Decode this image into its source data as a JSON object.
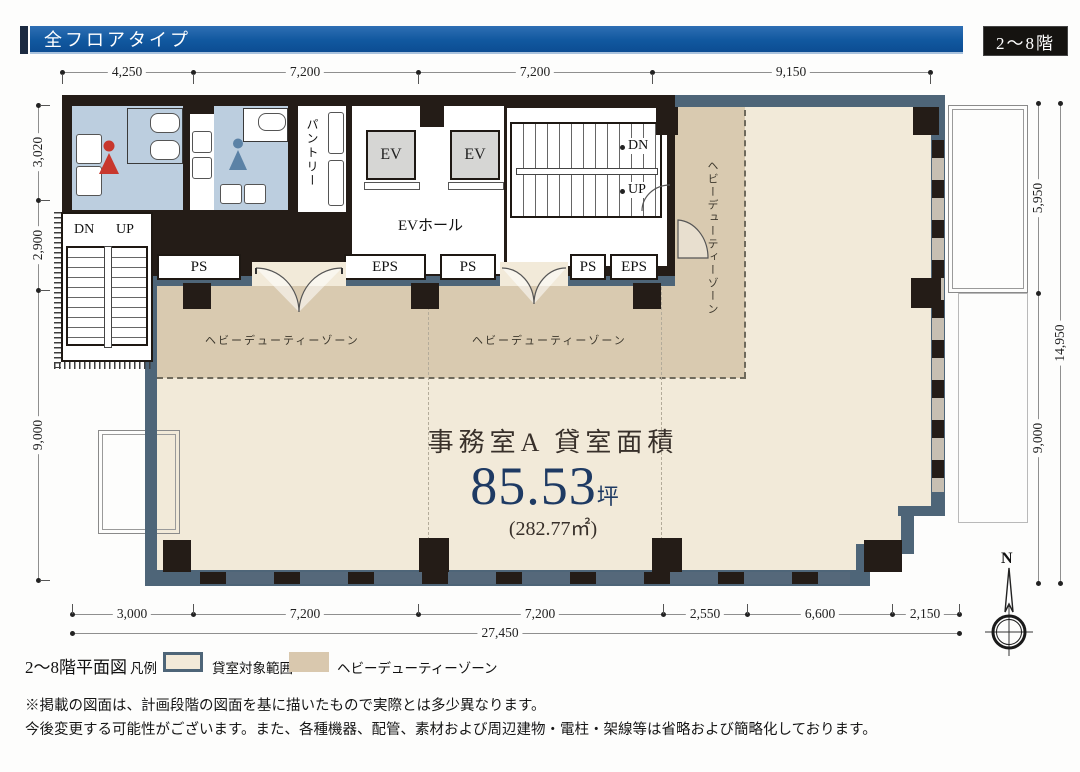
{
  "header": {
    "title": "全フロアタイプ",
    "floor_badge": "2〜8階"
  },
  "plan": {
    "core": {
      "pantry_label": "パントリー",
      "ev_labels": [
        "EV",
        "EV"
      ],
      "ev_hall_label": "EVホール",
      "main_stair": {
        "dn": "DN",
        "up": "UP"
      },
      "left_stair": {
        "dn": "DN",
        "up": "UP"
      }
    },
    "shaft_labels": [
      "PS",
      "EPS",
      "PS",
      "PS",
      "EPS"
    ],
    "zones": {
      "heavy_duty_horizontal": [
        "ヘビーデューティーゾーン",
        "ヘビーデューティーゾーン"
      ],
      "heavy_duty_vertical": "ヘビーデューティーゾーン"
    },
    "office": {
      "title": "事務室A 貸室面積",
      "area_value": "85.53",
      "area_unit": "坪",
      "area_m2": "(282.77㎡)"
    },
    "compass": {
      "label": "N"
    }
  },
  "dimensions": {
    "top": [
      "4,250",
      "7,200",
      "7,200",
      "9,150"
    ],
    "left": [
      "3,020",
      "2,900",
      "9,000"
    ],
    "right": [
      "5,950",
      "9,000"
    ],
    "right_total": "14,950",
    "bottom": [
      "3,000",
      "7,200",
      "7,200",
      "2,550",
      "6,600",
      "2,150"
    ],
    "bottom_total": "27,450"
  },
  "legend": {
    "plan_title": "2〜8階平面図",
    "legend_label": "凡例",
    "items": [
      {
        "label": "貸室対象範囲",
        "color": "#f3ead9"
      },
      {
        "label": "ヘビーデューティーゾーン",
        "color": "#d9c8ae"
      }
    ]
  },
  "notes": [
    "※掲載の図面は、計画段階の図面を基に描いたもので実際とは多少異なります。",
    "今後変更する可能性がございます。また、各種機器、配管、素材および周辺建物・電柱・架線等は省略および簡略化しております。"
  ],
  "colors": {
    "header_blue": "#11589f",
    "wall_blue_gray": "#4e6578",
    "wall_black": "#241c17",
    "tenant_beige": "#f2ead9",
    "heavy_duty_beige": "#d9cab0",
    "wc_blue": "#bccedf",
    "area_navy": "#1e3a63",
    "women_icon_red": "#c8372d",
    "men_icon_blue": "#5b82a6"
  }
}
